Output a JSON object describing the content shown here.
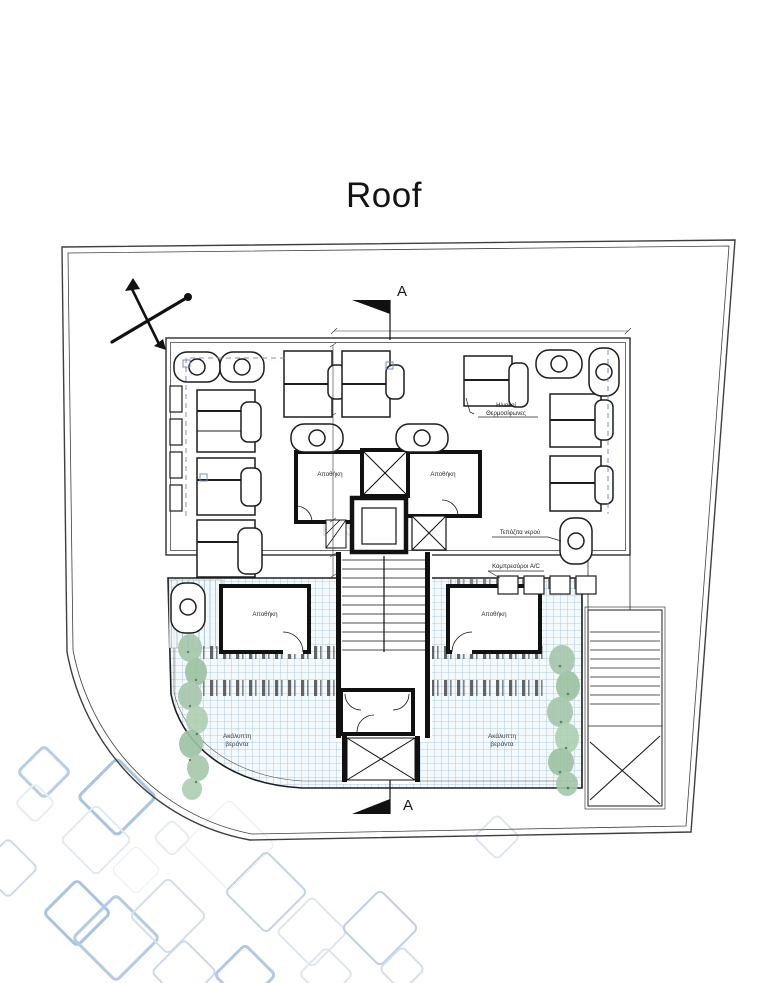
{
  "title": "Roof",
  "watermark": {
    "name": "KTIS",
    "subtitle": "ESTATE"
  },
  "section": {
    "top_label": "A",
    "bottom_label": "A"
  },
  "labels": {
    "solar_heaters_line1": "Ηλιακοί",
    "solar_heaters_line2": "Θερμοσίφωνες",
    "water_tanks": "Τεπόζιτα νερού",
    "ac_compressors": "Κομπρεσόροι A/C",
    "storage_upper_left": "Αποθήκη",
    "storage_upper_right": "Αποθήκη",
    "storage_lower_left": "Αποθήκη",
    "storage_lower_right": "Αποθήκη",
    "terrace_left_line1": "Ακάλυπτη",
    "terrace_left_line2": "βεράντα",
    "terrace_right_line1": "Ακάλυπτη",
    "terrace_right_line2": "βεράντα"
  },
  "colors": {
    "line_dark": "#2e2e2e",
    "hatch_line": "#9dc0d8",
    "hatch_bg": "#f4f9fc",
    "dashed_guide": "#7d88c8",
    "vegetation": "#a5c7aa",
    "watermark_gray": "#c7c7c7",
    "watermark_gold": "#c9a84c",
    "diamond_blue": "#a9c3e1"
  }
}
